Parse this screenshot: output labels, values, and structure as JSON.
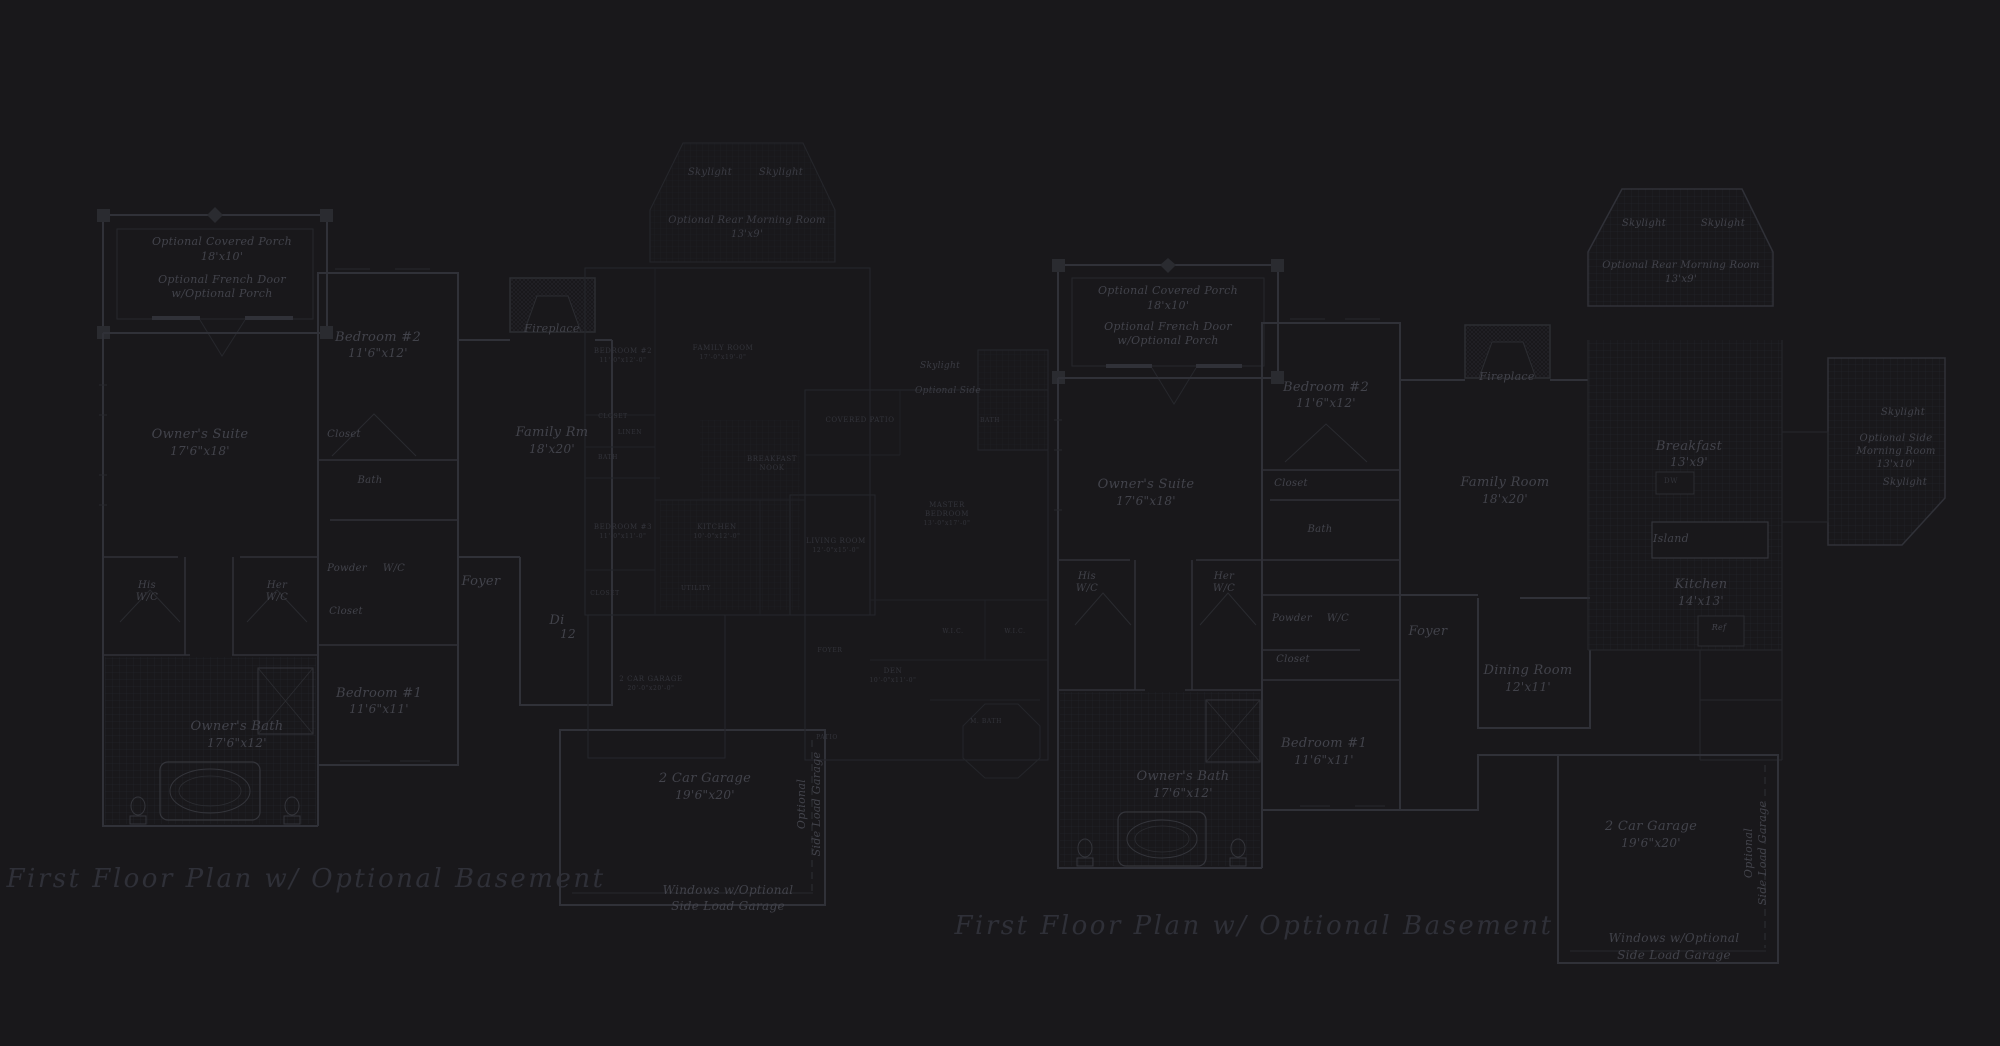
{
  "palette": {
    "background": "#19181b",
    "wall": "#303138",
    "wall_faint": "#25262b",
    "tile_line": "#222329",
    "label": "#42434b",
    "label_dim": "#33343b",
    "title": "#2f3038"
  },
  "titles": [
    {
      "text": "First Floor Plan  w/ Optional Basement"
    },
    {
      "text": "First Floor Plan  w/ Optional Basement"
    }
  ],
  "plans": [
    {
      "id": "left",
      "name": "first-floor-plan-left",
      "labels": [
        {
          "text": "Optional Covered Porch",
          "x": 222,
          "y": 236,
          "size": 11
        },
        {
          "text": "18'x10'",
          "x": 222,
          "y": 251,
          "size": 11
        },
        {
          "text": "Optional French Door",
          "x": 222,
          "y": 274,
          "size": 11
        },
        {
          "text": "w/Optional Porch",
          "x": 222,
          "y": 288,
          "size": 11
        },
        {
          "text": "Bedroom #2",
          "x": 378,
          "y": 331,
          "size": 13
        },
        {
          "text": "11'6\"x12'",
          "x": 378,
          "y": 347,
          "size": 12
        },
        {
          "text": "Owner's Suite",
          "x": 200,
          "y": 428,
          "size": 13
        },
        {
          "text": "17'6\"x18'",
          "x": 200,
          "y": 445,
          "size": 12
        },
        {
          "text": "Closet",
          "x": 344,
          "y": 430,
          "size": 10
        },
        {
          "text": "Bath",
          "x": 370,
          "y": 476,
          "size": 10
        },
        {
          "text": "His",
          "x": 147,
          "y": 581,
          "size": 10
        },
        {
          "text": "W/C",
          "x": 147,
          "y": 593,
          "size": 10
        },
        {
          "text": "Her",
          "x": 277,
          "y": 581,
          "size": 10
        },
        {
          "text": "W/C",
          "x": 277,
          "y": 593,
          "size": 10
        },
        {
          "text": "Powder",
          "x": 347,
          "y": 564,
          "size": 10
        },
        {
          "text": "W/C",
          "x": 394,
          "y": 564,
          "size": 10
        },
        {
          "text": "Closet",
          "x": 346,
          "y": 607,
          "size": 10
        },
        {
          "text": "Foyer",
          "x": 481,
          "y": 575,
          "size": 13
        },
        {
          "text": "Family Rm",
          "x": 552,
          "y": 426,
          "size": 13
        },
        {
          "text": "18'x20'",
          "x": 552,
          "y": 443,
          "size": 12
        },
        {
          "text": "Fireplace",
          "x": 552,
          "y": 323,
          "size": 11
        },
        {
          "text": "Di",
          "x": 557,
          "y": 614,
          "size": 13
        },
        {
          "text": "12",
          "x": 568,
          "y": 628,
          "size": 12
        },
        {
          "text": "Bedroom #1",
          "x": 379,
          "y": 687,
          "size": 13
        },
        {
          "text": "11'6\"x11'",
          "x": 379,
          "y": 703,
          "size": 12
        },
        {
          "text": "Owner's Bath",
          "x": 237,
          "y": 720,
          "size": 13
        },
        {
          "text": "17'6\"x12'",
          "x": 237,
          "y": 737,
          "size": 12
        },
        {
          "text": "2 Car Garage",
          "x": 705,
          "y": 772,
          "size": 13
        },
        {
          "text": "19'6\"x20'",
          "x": 705,
          "y": 789,
          "size": 12
        },
        {
          "text": "Optional",
          "x": 802,
          "y": 804,
          "size": 11,
          "rot": -90
        },
        {
          "text": "Side Load Garage",
          "x": 817,
          "y": 804,
          "size": 11,
          "rot": -90
        },
        {
          "text": "Windows w/Optional",
          "x": 728,
          "y": 884,
          "size": 12
        },
        {
          "text": "Side Load Garage",
          "x": 728,
          "y": 900,
          "size": 12
        }
      ]
    },
    {
      "id": "middle",
      "name": "small-scale-plan-center",
      "labels": [
        {
          "text": "Skylight",
          "x": 710,
          "y": 168,
          "size": 10,
          "cls": "ital"
        },
        {
          "text": "Skylight",
          "x": 781,
          "y": 168,
          "size": 10,
          "cls": "ital"
        },
        {
          "text": "Optional Rear Morning Room",
          "x": 747,
          "y": 216,
          "size": 10,
          "cls": "ital"
        },
        {
          "text": "13'x9'",
          "x": 747,
          "y": 230,
          "size": 10,
          "cls": "ital"
        },
        {
          "text": "BEDROOM #2",
          "x": 623,
          "y": 348,
          "size": 7,
          "cls": "caps"
        },
        {
          "text": "11'-0\"x12'-0\"",
          "x": 623,
          "y": 358,
          "size": 6,
          "cls": "caps"
        },
        {
          "text": "FAMILY ROOM",
          "x": 723,
          "y": 345,
          "size": 7,
          "cls": "caps"
        },
        {
          "text": "17'-0\"x19'-0\"",
          "x": 723,
          "y": 355,
          "size": 6,
          "cls": "caps"
        },
        {
          "text": "CLOSET",
          "x": 613,
          "y": 414,
          "size": 6,
          "cls": "caps"
        },
        {
          "text": "LINEN",
          "x": 630,
          "y": 430,
          "size": 6,
          "cls": "caps"
        },
        {
          "text": "BATH",
          "x": 608,
          "y": 455,
          "size": 6,
          "cls": "caps"
        },
        {
          "text": "BREAKFAST",
          "x": 772,
          "y": 456,
          "size": 7,
          "cls": "caps"
        },
        {
          "text": "NOOK",
          "x": 772,
          "y": 465,
          "size": 7,
          "cls": "caps"
        },
        {
          "text": "BEDROOM #3",
          "x": 623,
          "y": 524,
          "size": 7,
          "cls": "caps"
        },
        {
          "text": "11'-0\"x11'-0\"",
          "x": 623,
          "y": 534,
          "size": 6,
          "cls": "caps"
        },
        {
          "text": "KITCHEN",
          "x": 717,
          "y": 524,
          "size": 7,
          "cls": "caps"
        },
        {
          "text": "10'-0\"x12'-0\"",
          "x": 717,
          "y": 534,
          "size": 6,
          "cls": "caps"
        },
        {
          "text": "COVERED PATIO",
          "x": 860,
          "y": 417,
          "size": 7,
          "cls": "caps"
        },
        {
          "text": "Skylight",
          "x": 940,
          "y": 362,
          "size": 9,
          "cls": "ital"
        },
        {
          "text": "Optional Side",
          "x": 948,
          "y": 387,
          "size": 9,
          "cls": "ital"
        },
        {
          "text": "BATH",
          "x": 990,
          "y": 418,
          "size": 6,
          "cls": "caps"
        },
        {
          "text": "LIVING ROOM",
          "x": 836,
          "y": 538,
          "size": 7,
          "cls": "caps"
        },
        {
          "text": "12'-0\"x15'-0\"",
          "x": 836,
          "y": 548,
          "size": 6,
          "cls": "caps"
        },
        {
          "text": "MASTER",
          "x": 947,
          "y": 502,
          "size": 7,
          "cls": "caps"
        },
        {
          "text": "BEDROOM",
          "x": 947,
          "y": 511,
          "size": 7,
          "cls": "caps"
        },
        {
          "text": "13'-0\"x17'-0\"",
          "x": 947,
          "y": 521,
          "size": 6,
          "cls": "caps"
        },
        {
          "text": "CLOSET",
          "x": 605,
          "y": 591,
          "size": 6,
          "cls": "caps"
        },
        {
          "text": "UTILITY",
          "x": 696,
          "y": 586,
          "size": 6,
          "cls": "caps"
        },
        {
          "text": "2 CAR GARAGE",
          "x": 651,
          "y": 676,
          "size": 7,
          "cls": "caps"
        },
        {
          "text": "20'-0\"x20'-0\"",
          "x": 651,
          "y": 686,
          "size": 6,
          "cls": "caps"
        },
        {
          "text": "FOYER",
          "x": 830,
          "y": 648,
          "size": 6,
          "cls": "caps"
        },
        {
          "text": "W.I.C.",
          "x": 953,
          "y": 629,
          "size": 6,
          "cls": "caps"
        },
        {
          "text": "W.I.C.",
          "x": 1015,
          "y": 629,
          "size": 6,
          "cls": "caps"
        },
        {
          "text": "DEN",
          "x": 893,
          "y": 668,
          "size": 7,
          "cls": "caps"
        },
        {
          "text": "10'-0\"x11'-0\"",
          "x": 893,
          "y": 678,
          "size": 6,
          "cls": "caps"
        },
        {
          "text": "M. BATH",
          "x": 986,
          "y": 719,
          "size": 6,
          "cls": "caps"
        },
        {
          "text": "PATIO",
          "x": 827,
          "y": 735,
          "size": 6,
          "cls": "caps"
        }
      ]
    },
    {
      "id": "right",
      "name": "first-floor-plan-right",
      "labels": [
        {
          "text": "Optional Covered Porch",
          "x": 1168,
          "y": 285,
          "size": 11
        },
        {
          "text": "18'x10'",
          "x": 1168,
          "y": 300,
          "size": 11
        },
        {
          "text": "Optional French Door",
          "x": 1168,
          "y": 321,
          "size": 11
        },
        {
          "text": "w/Optional Porch",
          "x": 1168,
          "y": 335,
          "size": 11
        },
        {
          "text": "Skylight",
          "x": 1644,
          "y": 219,
          "size": 10
        },
        {
          "text": "Skylight",
          "x": 1723,
          "y": 219,
          "size": 10
        },
        {
          "text": "Optional Rear Morning Room",
          "x": 1681,
          "y": 261,
          "size": 10
        },
        {
          "text": "13'x9'",
          "x": 1681,
          "y": 275,
          "size": 10
        },
        {
          "text": "Bedroom #2",
          "x": 1326,
          "y": 381,
          "size": 13
        },
        {
          "text": "11'6\"x12'",
          "x": 1326,
          "y": 397,
          "size": 12
        },
        {
          "text": "Owner's Suite",
          "x": 1146,
          "y": 478,
          "size": 13
        },
        {
          "text": "17'6\"x18'",
          "x": 1146,
          "y": 495,
          "size": 12
        },
        {
          "text": "Closet",
          "x": 1291,
          "y": 479,
          "size": 10
        },
        {
          "text": "Bath",
          "x": 1320,
          "y": 525,
          "size": 10
        },
        {
          "text": "Fireplace",
          "x": 1507,
          "y": 371,
          "size": 11
        },
        {
          "text": "Family Room",
          "x": 1505,
          "y": 476,
          "size": 13
        },
        {
          "text": "18'x20'",
          "x": 1505,
          "y": 493,
          "size": 12
        },
        {
          "text": "Breakfast",
          "x": 1689,
          "y": 440,
          "size": 13
        },
        {
          "text": "13'x9'",
          "x": 1689,
          "y": 456,
          "size": 12
        },
        {
          "text": "DW",
          "x": 1671,
          "y": 478,
          "size": 7,
          "cls": "caps"
        },
        {
          "text": "Island",
          "x": 1671,
          "y": 533,
          "size": 11
        },
        {
          "text": "Kitchen",
          "x": 1701,
          "y": 578,
          "size": 13
        },
        {
          "text": "14'x13'",
          "x": 1701,
          "y": 595,
          "size": 12
        },
        {
          "text": "Ref",
          "x": 1719,
          "y": 624,
          "size": 8
        },
        {
          "text": "Skylight",
          "x": 1903,
          "y": 408,
          "size": 10
        },
        {
          "text": "Optional Side",
          "x": 1896,
          "y": 434,
          "size": 10
        },
        {
          "text": "Morning Room",
          "x": 1896,
          "y": 447,
          "size": 10
        },
        {
          "text": "13'x10'",
          "x": 1896,
          "y": 460,
          "size": 10
        },
        {
          "text": "Skylight",
          "x": 1905,
          "y": 478,
          "size": 10
        },
        {
          "text": "His",
          "x": 1087,
          "y": 572,
          "size": 10
        },
        {
          "text": "W/C",
          "x": 1087,
          "y": 584,
          "size": 10
        },
        {
          "text": "Her",
          "x": 1224,
          "y": 572,
          "size": 10
        },
        {
          "text": "W/C",
          "x": 1224,
          "y": 584,
          "size": 10
        },
        {
          "text": "Powder",
          "x": 1292,
          "y": 614,
          "size": 10
        },
        {
          "text": "W/C",
          "x": 1338,
          "y": 614,
          "size": 10
        },
        {
          "text": "Closet",
          "x": 1293,
          "y": 655,
          "size": 10
        },
        {
          "text": "Foyer",
          "x": 1428,
          "y": 625,
          "size": 13
        },
        {
          "text": "Dining Room",
          "x": 1528,
          "y": 664,
          "size": 13
        },
        {
          "text": "12'x11'",
          "x": 1528,
          "y": 681,
          "size": 12
        },
        {
          "text": "Bedroom #1",
          "x": 1324,
          "y": 737,
          "size": 13
        },
        {
          "text": "11'6\"x11'",
          "x": 1324,
          "y": 754,
          "size": 12
        },
        {
          "text": "Owner's Bath",
          "x": 1183,
          "y": 770,
          "size": 13
        },
        {
          "text": "17'6\"x12'",
          "x": 1183,
          "y": 787,
          "size": 12
        },
        {
          "text": "2 Car Garage",
          "x": 1651,
          "y": 820,
          "size": 13
        },
        {
          "text": "19'6\"x20'",
          "x": 1651,
          "y": 837,
          "size": 12
        },
        {
          "text": "Optional",
          "x": 1749,
          "y": 853,
          "size": 11,
          "rot": -90
        },
        {
          "text": "Side Load Garage",
          "x": 1763,
          "y": 853,
          "size": 11,
          "rot": -90
        },
        {
          "text": "Windows w/Optional",
          "x": 1674,
          "y": 932,
          "size": 12
        },
        {
          "text": "Side Load Garage",
          "x": 1674,
          "y": 949,
          "size": 12
        }
      ]
    }
  ]
}
